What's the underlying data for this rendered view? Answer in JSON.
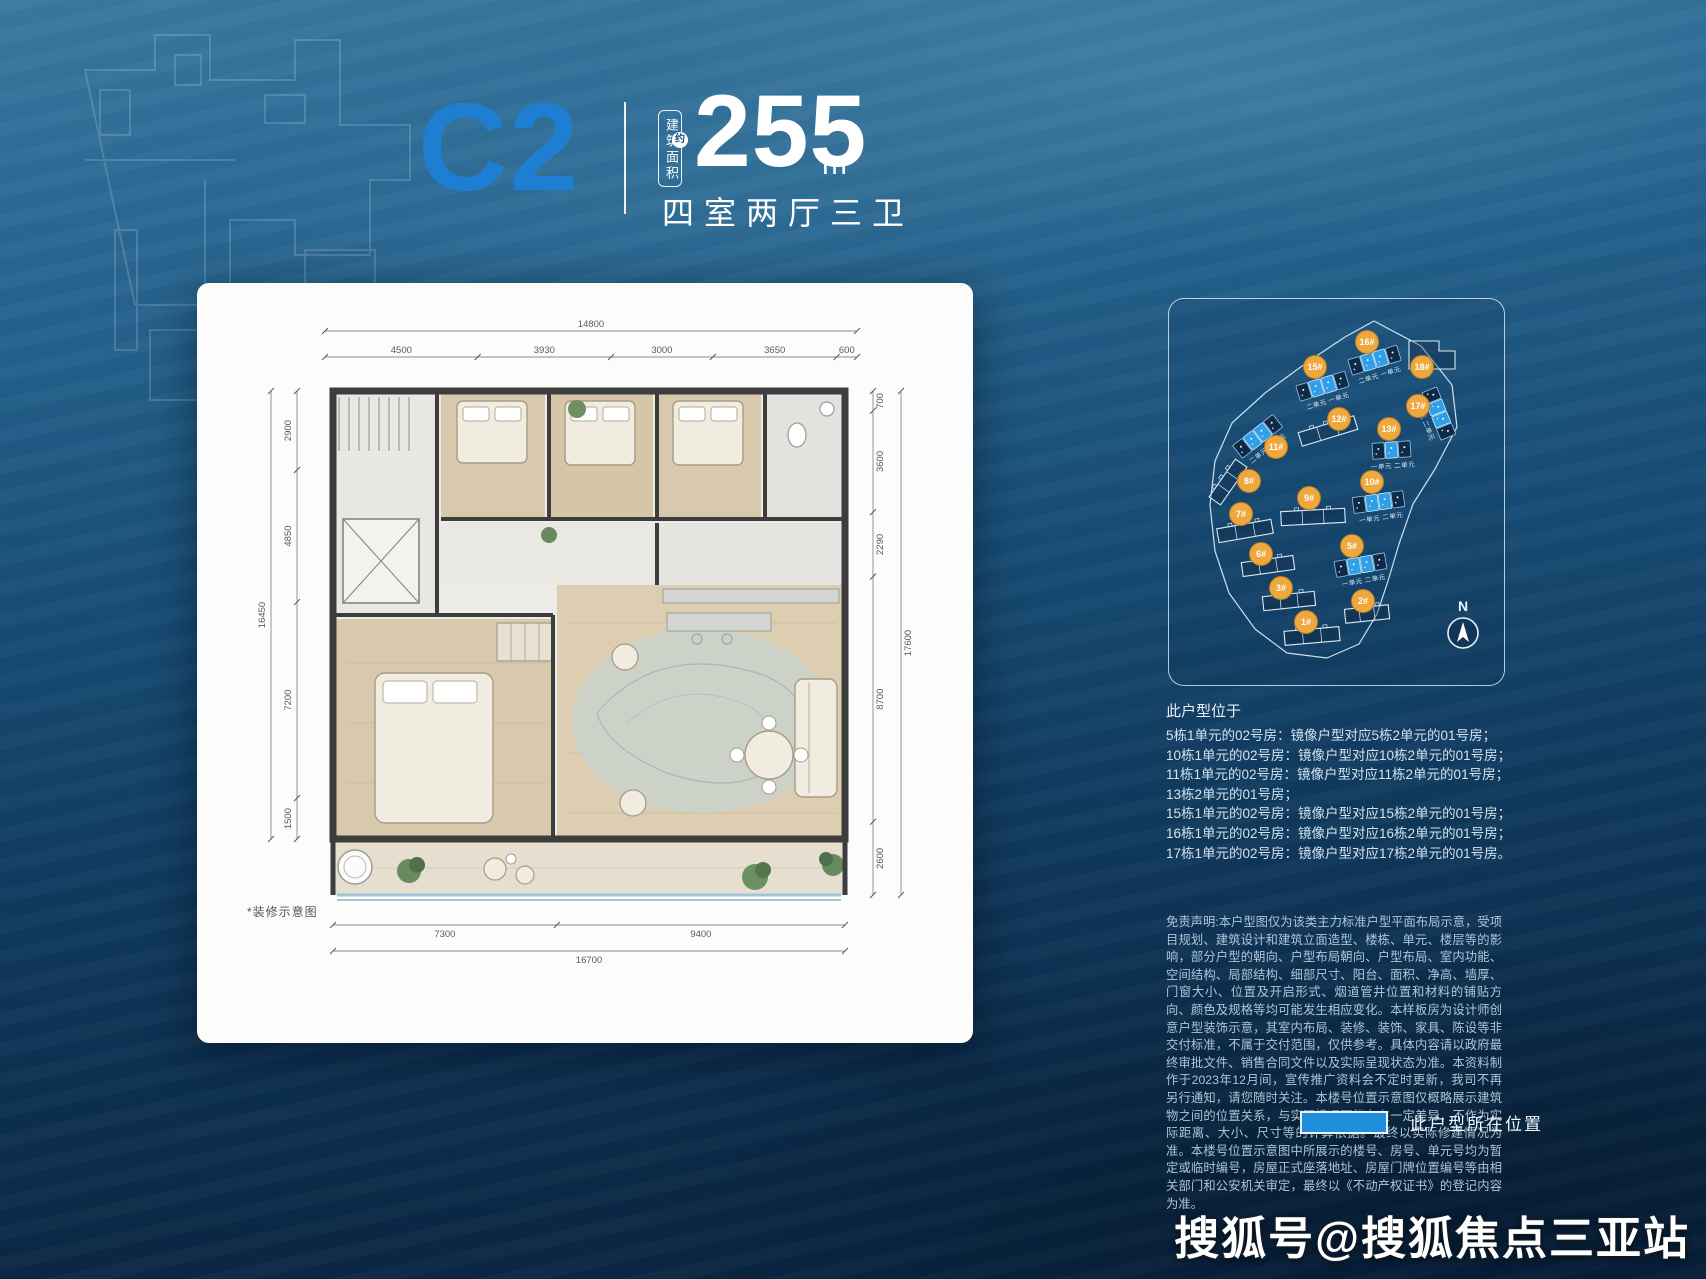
{
  "page": {
    "watermark": "搜狐号@搜狐焦点三亚站"
  },
  "header": {
    "unit_code": "C2",
    "area_label_vertical": "建筑面积",
    "area_approx": "约",
    "area_value": "255",
    "area_unit": "m",
    "area_unit_exp": "2",
    "layout_text": "四室两厅三卫"
  },
  "floorplan_card": {
    "note": "*装修示意图",
    "dimensions": {
      "top_total": "14800",
      "top_segments": [
        "4500",
        "3930",
        "3000",
        "3650",
        "600"
      ],
      "bottom_segments": [
        "7300",
        "9400"
      ],
      "bottom_total": "16700",
      "left_segments": [
        "2900",
        "4850",
        "7200",
        "1500"
      ],
      "left_total": "16450",
      "right_segments": [
        "700",
        "3600",
        "2290",
        "8700",
        "2600"
      ],
      "right_total": "17600"
    }
  },
  "site_plan": {
    "compass": "N",
    "boundary": [
      [
        205,
        22
      ],
      [
        252,
        47
      ],
      [
        283,
        86
      ],
      [
        288,
        128
      ],
      [
        266,
        170
      ],
      [
        244,
        205
      ],
      [
        230,
        245
      ],
      [
        219,
        282
      ],
      [
        208,
        315
      ],
      [
        190,
        345
      ],
      [
        158,
        359
      ],
      [
        118,
        354
      ],
      [
        86,
        330
      ],
      [
        60,
        294
      ],
      [
        46,
        252
      ],
      [
        41,
        206
      ],
      [
        46,
        162
      ],
      [
        63,
        124
      ],
      [
        96,
        94
      ],
      [
        140,
        62
      ],
      [
        176,
        38
      ]
    ],
    "buildings": [
      {
        "id": "1#",
        "badge": [
          137,
          323
        ],
        "bar": [
          143,
          337
        ],
        "rot": -5,
        "kind": "outline",
        "len": 55
      },
      {
        "id": "2#",
        "badge": [
          194,
          302
        ],
        "bar": [
          198,
          315
        ],
        "rot": -6,
        "kind": "outline",
        "len": 44
      },
      {
        "id": "3#",
        "badge": [
          112,
          289
        ],
        "bar": [
          120,
          302
        ],
        "rot": -6,
        "kind": "outline",
        "len": 52
      },
      {
        "id": "5#",
        "badge": [
          183,
          247
        ],
        "bar": [
          192,
          266
        ],
        "rot": -10,
        "kind": "units",
        "cells": [
          0,
          1,
          1,
          0
        ],
        "label": "一单元 二单元"
      },
      {
        "id": "6#",
        "badge": [
          92,
          255
        ],
        "bar": [
          99,
          267
        ],
        "rot": -8,
        "kind": "outline",
        "len": 52
      },
      {
        "id": "7#",
        "badge": [
          72,
          215
        ],
        "bar": [
          76,
          232
        ],
        "rot": -10,
        "kind": "outline",
        "len": 55
      },
      {
        "id": "8#",
        "badge": [
          80,
          182
        ],
        "bar": [
          59,
          183
        ],
        "rot": -55,
        "kind": "outline",
        "len": 46
      },
      {
        "id": "9#",
        "badge": [
          140,
          199
        ],
        "bar": [
          144,
          218
        ],
        "rot": -3,
        "kind": "outline",
        "len": 64
      },
      {
        "id": "10#",
        "badge": [
          203,
          183
        ],
        "bar": [
          210,
          203
        ],
        "rot": -8,
        "kind": "units",
        "cells": [
          0,
          1,
          1,
          0
        ],
        "label": "一单元 二单元"
      },
      {
        "id": "11#",
        "badge": [
          107,
          148
        ],
        "bar": [
          89,
          137
        ],
        "rot": -38,
        "kind": "units",
        "cells": [
          0,
          1,
          1,
          0
        ],
        "label": "二单元 一单元"
      },
      {
        "id": "12#",
        "badge": [
          170,
          120
        ],
        "bar": [
          159,
          132
        ],
        "rot": -17,
        "kind": "outline",
        "len": 58
      },
      {
        "id": "13#",
        "badge": [
          220,
          130
        ],
        "bar": [
          223,
          151
        ],
        "rot": -4,
        "kind": "units",
        "cells": [
          0,
          1,
          0
        ],
        "label": "一单元 二单元"
      },
      {
        "id": "15#",
        "badge": [
          146,
          68
        ],
        "bar": [
          154,
          87
        ],
        "rot": -17,
        "kind": "units",
        "cells": [
          0,
          1,
          1,
          0
        ],
        "label": "二单元 一单元"
      },
      {
        "id": "16#",
        "badge": [
          198,
          43
        ],
        "bar": [
          206,
          61
        ],
        "rot": -17,
        "kind": "units",
        "cells": [
          0,
          1,
          1,
          0
        ],
        "label": "二单元 一单元"
      },
      {
        "id": "17#",
        "badge": [
          249,
          107
        ],
        "bar": [
          270,
          115
        ],
        "rot": 68,
        "kind": "units",
        "cells": [
          0,
          1,
          1,
          0
        ],
        "label": "一单元 二单元"
      },
      {
        "id": "18#",
        "badge": [
          253,
          68
        ],
        "bar": [
          264,
          58
        ],
        "rot": 0,
        "kind": "L"
      }
    ]
  },
  "location_info": {
    "title": "此户型位于",
    "lines": [
      "5栋1单元的02号房：镜像户型对应5栋2单元的01号房；",
      "10栋1单元的02号房：镜像户型对应10栋2单元的01号房；",
      "11栋1单元的02号房：镜像户型对应11栋2单元的01号房；",
      "13栋2单元的01号房；",
      "15栋1单元的02号房：镜像户型对应15栋2单元的01号房；",
      "16栋1单元的02号房：镜像户型对应16栋2单元的01号房；",
      "17栋1单元的02号房：镜像户型对应17栋2单元的01号房。"
    ]
  },
  "disclaimer": "免责声明:本户型图仅为该类主力标准户型平面布局示意，受项目规划、建筑设计和建筑立面造型、楼栋、单元、楼层等的影响，部分户型的朝向、户型布局朝向、户型布局、室内功能、空间结构、局部结构、细部尺寸、阳台、面积、净高、墙厚、门窗大小、位置及开启形式、烟道管井位置和材料的铺贴方向、颜色及规格等均可能发生相应变化。本样板房为设计师创意户型装饰示意，其室内布局、装修、装饰、家具、陈设等非交付标准，不属于交付范围，仅供参考。具体内容请以政府最终审批文件、销售合同文件以及实际呈现状态为准。本资料制作于2023年12月间，宣传推广资料会不定时更新，我司不再另行通知，请您随时关注。本楼号位置示意图仅概略展示建筑物之间的位置关系，与实际情况可能存在一定差异，不作为实际距离、大小、尺寸等的计算依据。最终以实际修建情况为准。本楼号位置示意图中所展示的楼号、房号、单元号均为暂定或临时编号，房屋正式座落地址、房屋门牌位置编号等由相关部门和公安机关审定，最终以《不动产权证书》的登记内容为准。",
  "legend": {
    "label": "此户型所在位置",
    "color": "#1f8fdc"
  },
  "colors": {
    "accent_blue": "#1e7ed2",
    "highlight_unit": "#2f9fe8",
    "dark_unit": "#0e2a47",
    "badge_orange": "#eda93f"
  }
}
